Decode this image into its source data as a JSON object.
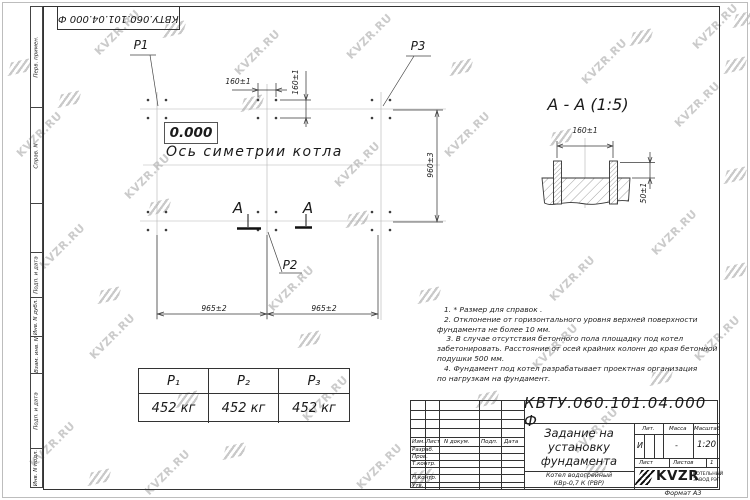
{
  "watermark": {
    "text": "KVZR.RU"
  },
  "frame": {
    "corner_stamp": "КВТУ.060.101.04.000  Ф",
    "format_label": "Формат А3",
    "margin_labels": [
      "Перв. примен.",
      "Справ. N",
      "Подп. и дата",
      "Инв. N дубл.",
      "Взам. инв. N",
      "Подп. и дата",
      "Инв. N подл."
    ]
  },
  "plan": {
    "elevation": "0.000",
    "axis_label": "Ось симетрии котла",
    "labels": {
      "p1": "P1",
      "p2": "P2",
      "p3": "P3"
    },
    "dims": {
      "top_h": "160±1",
      "top_v": "160±1",
      "right_v": "960±3",
      "bottom_left": "965±2",
      "bottom_right": "965±2"
    },
    "section_letter": "А"
  },
  "section": {
    "title": "А - А (1:5)",
    "dim_width": "160±1",
    "dim_height": "50±1"
  },
  "notes": {
    "lines": [
      "   1. * Размер для справок .",
      "   2. Отклонение от горизонтального уровня верхней поверхности",
      "фундамента не более 10 мм.",
      "    3. В случае отсутствия бетонного пола площадку под котел",
      "забетонировать. Расстояние от осей крайних колонн до края бетонной",
      "подушки 500 мм.",
      "   4. Фундамент под котел разрабатывает проектная организация",
      "по нагрузкам на фундамент."
    ]
  },
  "load_table": {
    "headers": [
      "Р₁",
      "Р₂",
      "Р₃"
    ],
    "values": [
      "452 кг",
      "452 кг",
      "452 кг"
    ]
  },
  "title_block": {
    "doc_number": "КВТУ.060.101.04.000  Ф",
    "title_lines": [
      "Задание на",
      "установку",
      "фундамента"
    ],
    "product_lines": [
      "Котел водогрейный",
      "КВр-0,7 К (РВР)"
    ],
    "rev_headers": [
      "Изм.",
      "Лист",
      "N докум.",
      "Подп.",
      "Дата"
    ],
    "roles": [
      "Разраб.",
      "Пров.",
      "Т.контр.",
      "Н.контр.",
      "Утв."
    ],
    "lit_label": "Лит.",
    "mass_label": "Масса",
    "scale_label": "Масштаб",
    "lit_value": "И",
    "mass_value": "-",
    "scale_value": "1:20",
    "sheet_label": "Лист",
    "sheets_label": "Листов",
    "sheets_value": "1",
    "logo_text": "KVZR",
    "logo_sub1": "КОТЕЛЬНЫЙ",
    "logo_sub2": "ЗАВОД РЭП"
  }
}
